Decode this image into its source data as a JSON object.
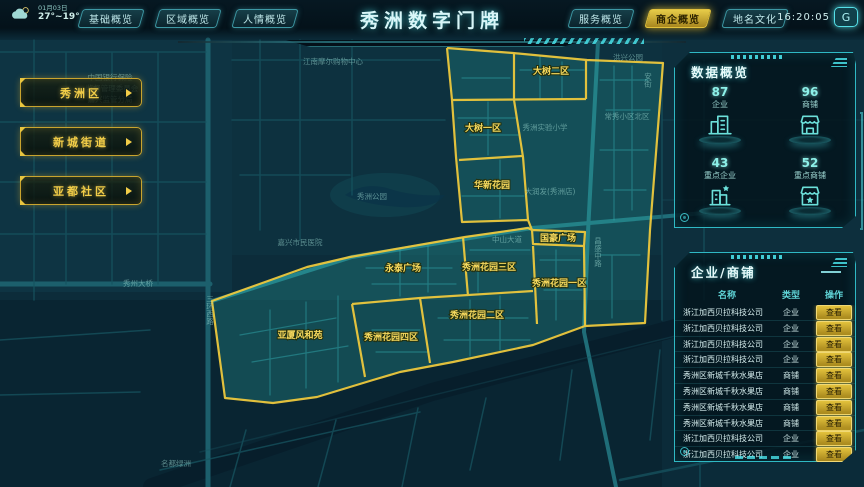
{
  "header": {
    "weather": {
      "date": "01月03日",
      "temp": "27°~19°"
    },
    "title": "秀洲数字门牌",
    "tabs_left": [
      {
        "label": "基础概览"
      },
      {
        "label": "区域概览"
      },
      {
        "label": "人情概览"
      }
    ],
    "tabs_right": [
      {
        "label": "服务概览"
      },
      {
        "label": "商企概览",
        "active": true
      },
      {
        "label": "地名文化"
      }
    ],
    "time": "16:20:05"
  },
  "left_nav": {
    "buttons": [
      {
        "label": "秀洲区"
      },
      {
        "label": "新城街道"
      },
      {
        "label": "亚都社区"
      }
    ]
  },
  "map": {
    "region_labels": [
      {
        "text": "大树二区",
        "x": 551,
        "y": 74
      },
      {
        "text": "大树一区",
        "x": 483,
        "y": 131
      },
      {
        "text": "华新花园",
        "x": 492,
        "y": 188
      },
      {
        "text": "国豪广场",
        "x": 558,
        "y": 241
      },
      {
        "text": "永泰广场",
        "x": 403,
        "y": 271
      },
      {
        "text": "秀洲花园三区",
        "x": 489,
        "y": 270
      },
      {
        "text": "秀洲花园一区",
        "x": 559,
        "y": 286
      },
      {
        "text": "秀洲花园二区",
        "x": 477,
        "y": 318
      },
      {
        "text": "秀洲花园四区",
        "x": 391,
        "y": 340
      },
      {
        "text": "亚厦风和苑",
        "x": 300,
        "y": 338
      }
    ],
    "poi_labels": [
      {
        "text": "江南摩尔购物中心",
        "x": 333,
        "y": 64
      },
      {
        "text": "洪兴公园",
        "x": 628,
        "y": 60
      },
      {
        "text": "常秀小区北区",
        "x": 627,
        "y": 119
      },
      {
        "text": "秀洲实验小学",
        "x": 545,
        "y": 130
      },
      {
        "text": "大润发(秀洲店)",
        "x": 550,
        "y": 194
      },
      {
        "text": "中山大道",
        "x": 507,
        "y": 242
      },
      {
        "text": "昌盛中路",
        "x": 598,
        "y": 252,
        "vertical": true
      },
      {
        "text": "嘉兴市民医院",
        "x": 300,
        "y": 245
      },
      {
        "text": "秀州大桥",
        "x": 138,
        "y": 286
      },
      {
        "text": "三环西路",
        "x": 210,
        "y": 310,
        "vertical": true
      },
      {
        "text": "秀洲公园",
        "x": 372,
        "y": 199
      },
      {
        "text": "名都绿洲",
        "x": 176,
        "y": 466
      },
      {
        "text": "中国银行保险",
        "x": 110,
        "y": 80
      },
      {
        "text": "监督管理委员会",
        "x": 112,
        "y": 91
      },
      {
        "text": "嘉兴监管分局",
        "x": 110,
        "y": 102
      },
      {
        "text": "安街",
        "x": 648,
        "y": 80,
        "vertical": true
      }
    ]
  },
  "data_overview": {
    "title": "数据概览",
    "stats": [
      {
        "value": "87",
        "label": "企业",
        "icon": "building-icon"
      },
      {
        "value": "96",
        "label": "商铺",
        "icon": "shop-icon"
      },
      {
        "value": "43",
        "label": "重点企业",
        "icon": "building-star-icon"
      },
      {
        "value": "52",
        "label": "重点商铺",
        "icon": "shop-star-icon"
      }
    ]
  },
  "business_panel": {
    "title": "企业/商铺",
    "columns": [
      "名称",
      "类型",
      "操作"
    ],
    "action_label": "查看",
    "rows": [
      {
        "name": "浙江加西贝拉科技公司",
        "type": "企业"
      },
      {
        "name": "浙江加西贝拉科技公司",
        "type": "企业"
      },
      {
        "name": "浙江加西贝拉科技公司",
        "type": "企业"
      },
      {
        "name": "浙江加西贝拉科技公司",
        "type": "企业"
      },
      {
        "name": "秀洲区新城千秋水果店",
        "type": "商铺"
      },
      {
        "name": "秀洲区新城千秋水果店",
        "type": "商铺"
      },
      {
        "name": "秀洲区新城千秋水果店",
        "type": "商铺"
      },
      {
        "name": "秀洲区新城千秋水果店",
        "type": "商铺"
      },
      {
        "name": "浙江加西贝拉科技公司",
        "type": "企业"
      },
      {
        "name": "浙江加西贝拉科技公司",
        "type": "企业"
      }
    ]
  },
  "colors": {
    "accent_cyan": "#49e0e8",
    "accent_yellow": "#e8c53f",
    "highlight_fill": "#3ae8d8",
    "panel_border": "#2fb9c4",
    "active_tab_bg": "#d4b832"
  }
}
